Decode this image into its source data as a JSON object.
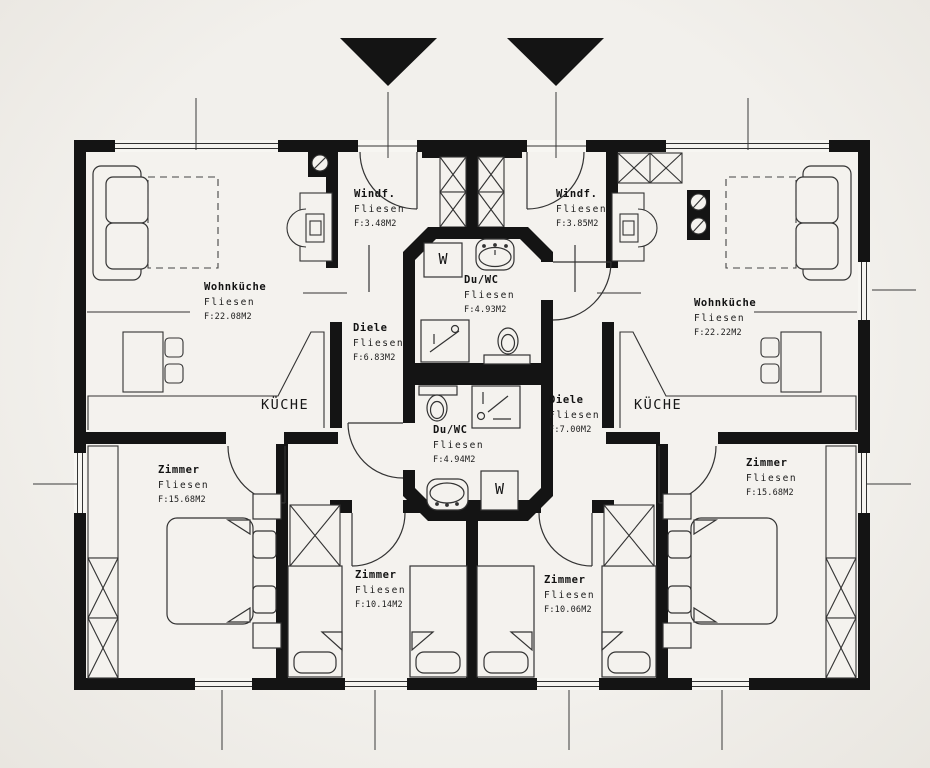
{
  "plan": {
    "type": "floor-plan",
    "units": 2,
    "background_color": "#f2f0ec",
    "line_color": "#141414",
    "icons": {
      "entrance_left": "filled-triangle-down",
      "entrance_right": "filled-triangle-down"
    }
  },
  "rooms": [
    {
      "id": "windfang-left",
      "name": "Windf.",
      "floor": "Fliesen",
      "area": "F:3.48M2"
    },
    {
      "id": "windfang-right",
      "name": "Windf.",
      "floor": "Fliesen",
      "area": "F:3.85M2"
    },
    {
      "id": "wohnkueche-left",
      "name": "Wohnküche",
      "floor": "Fliesen",
      "area": "F:22.08M2"
    },
    {
      "id": "wohnkueche-right",
      "name": "Wohnküche",
      "floor": "Fliesen",
      "area": "F:22.22M2"
    },
    {
      "id": "diele-left",
      "name": "Diele",
      "floor": "Fliesen",
      "area": "F:6.83M2"
    },
    {
      "id": "diele-right",
      "name": "Diele",
      "floor": "Fliesen",
      "area": "F:7.00M2"
    },
    {
      "id": "duwc-top",
      "name": "Du/WC",
      "floor": "Fliesen",
      "area": "F:4.93M2"
    },
    {
      "id": "duwc-bottom",
      "name": "Du/WC",
      "floor": "Fliesen",
      "area": "F:4.94M2"
    },
    {
      "id": "zimmer-left-large",
      "name": "Zimmer",
      "floor": "Fliesen",
      "area": "F:15.68M2"
    },
    {
      "id": "zimmer-left-small",
      "name": "Zimmer",
      "floor": "Fliesen",
      "area": "F:10.14M2"
    },
    {
      "id": "zimmer-right-small",
      "name": "Zimmer",
      "floor": "Fliesen",
      "area": "F:10.06M2"
    },
    {
      "id": "zimmer-right-large",
      "name": "Zimmer",
      "floor": "Fliesen",
      "area": "F:15.68M2"
    }
  ],
  "kitchen_labels": {
    "left": "KÜCHE",
    "right": "KÜCHE"
  },
  "fixtures": {
    "washer_top": "W",
    "washer_bottom": "W"
  }
}
